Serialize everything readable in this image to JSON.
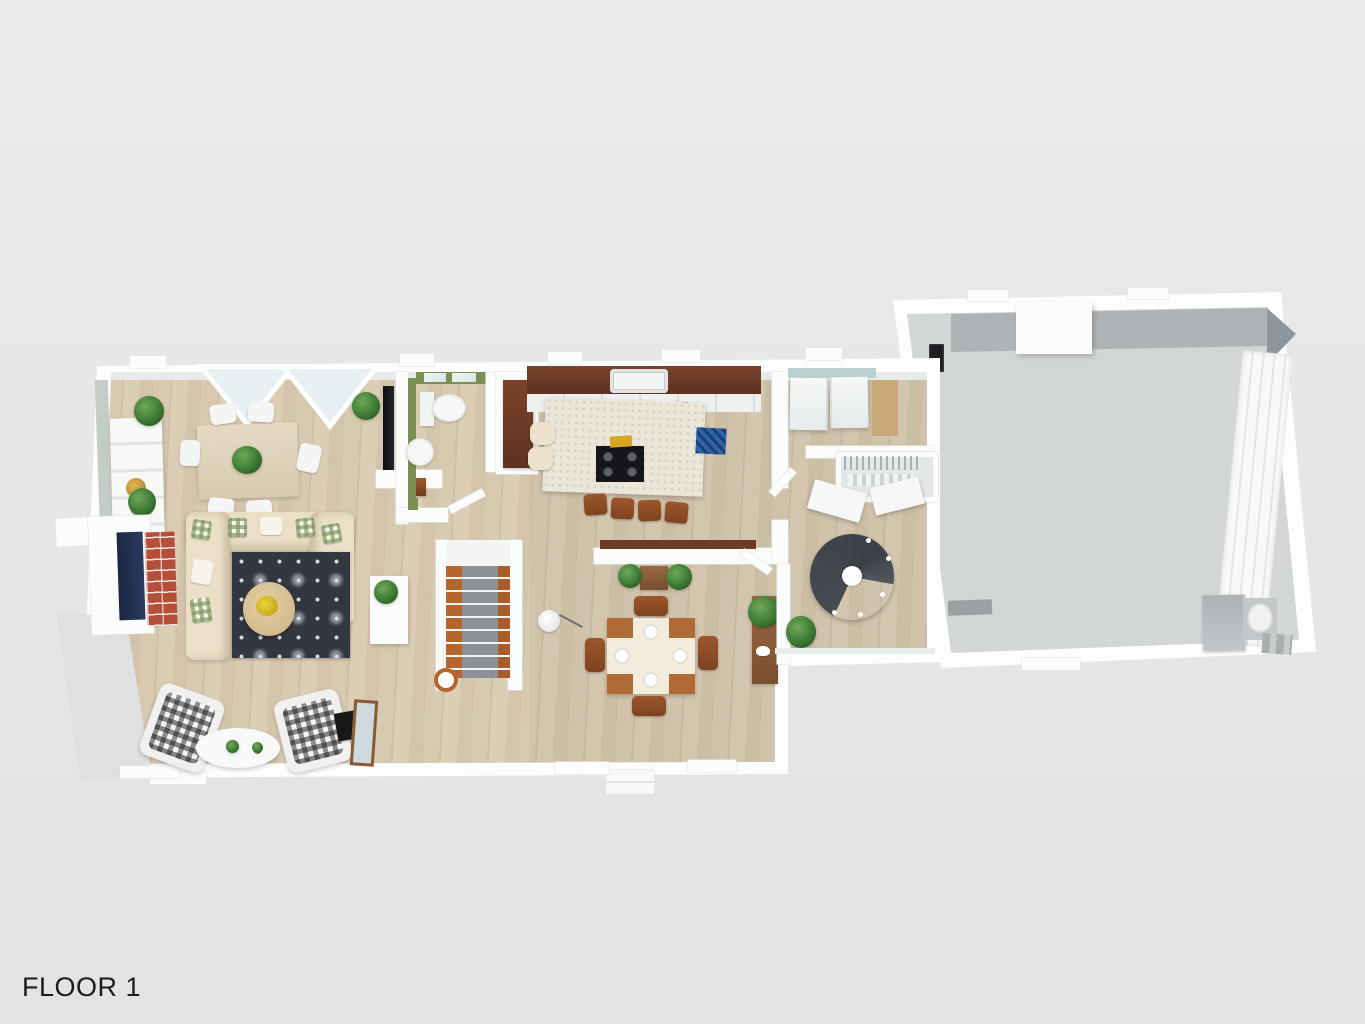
{
  "floorplan": {
    "floor_label": "FLOOR 1",
    "palette": {
      "background": "#e6e7e8",
      "wall_white": "#fbfcfc",
      "wood_floor": "#d7c8b0",
      "garage_floor": "#d3d6d7",
      "bathroom_green": "#7a8f52",
      "counter_walnut": "#6b3a24",
      "island_top": "#eae6da",
      "sofa_beige": "#ebdfc8",
      "living_rug_dark": "#33373f",
      "kitchen_rug_blue": "#2f63a8",
      "brick_red": "#b4503a",
      "firebox_navy": "#223052",
      "stair_wood": "#b5662f",
      "stair_runner": "#8d9196",
      "spiral_stair_gray": "#474b52",
      "laundry_wall_teal": "#b9cfd0",
      "plant_green": "#3c7a33"
    },
    "rooms": [
      "living-room",
      "dining-area",
      "bathroom",
      "kitchen",
      "breakfast-nook",
      "hallway",
      "staircase",
      "laundry-room",
      "mudroom",
      "garage"
    ],
    "furniture": [
      "dining-table",
      "dining-chairs",
      "hutch",
      "fireplace",
      "sectional-sofa",
      "area-rug",
      "round-coffee-table",
      "plaid-armchairs",
      "oval-coffee-table",
      "leaning-mirror",
      "wall-tv",
      "toilet",
      "bathroom-sink",
      "pantry-cabinet",
      "kitchen-counter",
      "kitchen-sink",
      "kitchen-island",
      "cooktop",
      "bar-stools",
      "blue-rug",
      "nook-table",
      "nook-chairs",
      "sideboard",
      "floor-lamp",
      "console-table",
      "washer",
      "dryer",
      "wire-shelf-closet",
      "benches",
      "spiral-staircase",
      "storage-cabinet",
      "garage-door",
      "furnace",
      "water-heater",
      "electrical-panel",
      "potted-plants",
      "front-steps",
      "patio"
    ]
  }
}
